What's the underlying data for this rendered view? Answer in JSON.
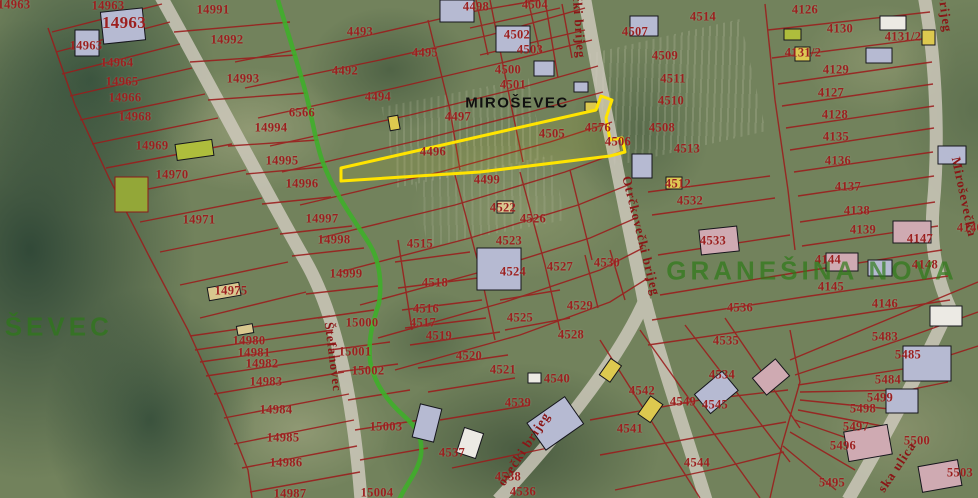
{
  "map": {
    "place_label": {
      "t": "MIROŠEVEC"
    },
    "district_labels": [
      {
        "t": "KUŠEVEC",
        "x": 36,
        "y": 327
      },
      {
        "t": "GRANEŠINA NOVA",
        "x": 812,
        "y": 271
      }
    ],
    "street_labels": [
      {
        "t": "Štefanovec",
        "x": 333,
        "y": 357,
        "r": 83
      },
      {
        "t": "čki brijeg",
        "x": 579,
        "y": 27,
        "r": 86
      },
      {
        "t": "Otrčkovečki brijeg",
        "x": 641,
        "y": 236,
        "r": 76
      },
      {
        "t": "ovečki brijeg",
        "x": 524,
        "y": 449,
        "r": -57
      },
      {
        "t": "Miroševečka",
        "x": 964,
        "y": 197,
        "r": 78
      },
      {
        "t": "brijeg",
        "x": 945,
        "y": 13,
        "r": 82
      },
      {
        "t": "ska ulica",
        "x": 897,
        "y": 467,
        "r": -56
      }
    ],
    "highlight_parcel": {
      "id": "4496",
      "outline": "#ffe400"
    },
    "parcel_labels": [
      {
        "t": "14963",
        "x": 14,
        "y": 5
      },
      {
        "t": "14963",
        "x": 108,
        "y": 6
      },
      {
        "t": "14963",
        "x": 124,
        "y": 23,
        "s": 17
      },
      {
        "t": "14963",
        "x": 86,
        "y": 46
      },
      {
        "t": "14964",
        "x": 117,
        "y": 63
      },
      {
        "t": "14965",
        "x": 122,
        "y": 82
      },
      {
        "t": "14966",
        "x": 125,
        "y": 98
      },
      {
        "t": "14968",
        "x": 135,
        "y": 117
      },
      {
        "t": "14969",
        "x": 152,
        "y": 146
      },
      {
        "t": "14970",
        "x": 172,
        "y": 175
      },
      {
        "t": "14971",
        "x": 199,
        "y": 220
      },
      {
        "t": "14975",
        "x": 231,
        "y": 291
      },
      {
        "t": "14980",
        "x": 249,
        "y": 341
      },
      {
        "t": "14981",
        "x": 254,
        "y": 353
      },
      {
        "t": "14982",
        "x": 262,
        "y": 364
      },
      {
        "t": "14983",
        "x": 266,
        "y": 382
      },
      {
        "t": "14984",
        "x": 276,
        "y": 410
      },
      {
        "t": "14985",
        "x": 283,
        "y": 438
      },
      {
        "t": "14986",
        "x": 286,
        "y": 463
      },
      {
        "t": "14987",
        "x": 290,
        "y": 494
      },
      {
        "t": "14991",
        "x": 213,
        "y": 10
      },
      {
        "t": "14992",
        "x": 227,
        "y": 40
      },
      {
        "t": "14993",
        "x": 243,
        "y": 79
      },
      {
        "t": "14994",
        "x": 271,
        "y": 128
      },
      {
        "t": "14995",
        "x": 282,
        "y": 161
      },
      {
        "t": "14996",
        "x": 302,
        "y": 184
      },
      {
        "t": "14997",
        "x": 322,
        "y": 219
      },
      {
        "t": "14998",
        "x": 334,
        "y": 240
      },
      {
        "t": "14999",
        "x": 346,
        "y": 274
      },
      {
        "t": "15000",
        "x": 362,
        "y": 323
      },
      {
        "t": "15001",
        "x": 355,
        "y": 352
      },
      {
        "t": "15002",
        "x": 368,
        "y": 371
      },
      {
        "t": "15003",
        "x": 386,
        "y": 427
      },
      {
        "t": "15004",
        "x": 377,
        "y": 493
      },
      {
        "t": "6566",
        "x": 302,
        "y": 113
      },
      {
        "t": "4492",
        "x": 345,
        "y": 71
      },
      {
        "t": "4493",
        "x": 360,
        "y": 32
      },
      {
        "t": "4494",
        "x": 378,
        "y": 97
      },
      {
        "t": "4495",
        "x": 425,
        "y": 53
      },
      {
        "t": "4496",
        "x": 433,
        "y": 152
      },
      {
        "t": "4497",
        "x": 458,
        "y": 117
      },
      {
        "t": "4498",
        "x": 476,
        "y": 7
      },
      {
        "t": "4499",
        "x": 487,
        "y": 180
      },
      {
        "t": "4500",
        "x": 508,
        "y": 70
      },
      {
        "t": "4501",
        "x": 513,
        "y": 85
      },
      {
        "t": "4502",
        "x": 517,
        "y": 35
      },
      {
        "t": "4503",
        "x": 530,
        "y": 50
      },
      {
        "t": "4504",
        "x": 535,
        "y": 5
      },
      {
        "t": "4505",
        "x": 552,
        "y": 134
      },
      {
        "t": "4506",
        "x": 618,
        "y": 142
      },
      {
        "t": "4507",
        "x": 635,
        "y": 32
      },
      {
        "t": "4508",
        "x": 662,
        "y": 128
      },
      {
        "t": "4509",
        "x": 665,
        "y": 56
      },
      {
        "t": "4510",
        "x": 671,
        "y": 101
      },
      {
        "t": "4511",
        "x": 673,
        "y": 79
      },
      {
        "t": "4512",
        "x": 678,
        "y": 184
      },
      {
        "t": "4513",
        "x": 687,
        "y": 149
      },
      {
        "t": "4514",
        "x": 703,
        "y": 17
      },
      {
        "t": "4515",
        "x": 420,
        "y": 244
      },
      {
        "t": "4516",
        "x": 426,
        "y": 309
      },
      {
        "t": "4517",
        "x": 423,
        "y": 323
      },
      {
        "t": "4518",
        "x": 435,
        "y": 283
      },
      {
        "t": "4519",
        "x": 439,
        "y": 336
      },
      {
        "t": "4520",
        "x": 469,
        "y": 356
      },
      {
        "t": "4521",
        "x": 503,
        "y": 370
      },
      {
        "t": "4522",
        "x": 503,
        "y": 208
      },
      {
        "t": "4523",
        "x": 509,
        "y": 241
      },
      {
        "t": "4524",
        "x": 513,
        "y": 272
      },
      {
        "t": "4525",
        "x": 520,
        "y": 318
      },
      {
        "t": "4526",
        "x": 533,
        "y": 219
      },
      {
        "t": "4527",
        "x": 560,
        "y": 267
      },
      {
        "t": "4528",
        "x": 571,
        "y": 335
      },
      {
        "t": "4529",
        "x": 580,
        "y": 306
      },
      {
        "t": "4530",
        "x": 607,
        "y": 263
      },
      {
        "t": "4532",
        "x": 690,
        "y": 201
      },
      {
        "t": "4533",
        "x": 713,
        "y": 241
      },
      {
        "t": "4534",
        "x": 722,
        "y": 375
      },
      {
        "t": "4535",
        "x": 726,
        "y": 341
      },
      {
        "t": "4536",
        "x": 740,
        "y": 308
      },
      {
        "t": "4536",
        "x": 523,
        "y": 492
      },
      {
        "t": "4537",
        "x": 452,
        "y": 453
      },
      {
        "t": "4538",
        "x": 508,
        "y": 477
      },
      {
        "t": "4539",
        "x": 518,
        "y": 403
      },
      {
        "t": "4540",
        "x": 557,
        "y": 379
      },
      {
        "t": "4541",
        "x": 630,
        "y": 429
      },
      {
        "t": "4542",
        "x": 642,
        "y": 391
      },
      {
        "t": "4544",
        "x": 697,
        "y": 463
      },
      {
        "t": "4545",
        "x": 715,
        "y": 405
      },
      {
        "t": "4549",
        "x": 683,
        "y": 402
      },
      {
        "t": "4576",
        "x": 598,
        "y": 128
      },
      {
        "t": "4126",
        "x": 805,
        "y": 10
      },
      {
        "t": "4127",
        "x": 831,
        "y": 93
      },
      {
        "t": "4128",
        "x": 835,
        "y": 115
      },
      {
        "t": "4129",
        "x": 836,
        "y": 70
      },
      {
        "t": "4130",
        "x": 840,
        "y": 29
      },
      {
        "t": "4131/2",
        "x": 803,
        "y": 53
      },
      {
        "t": "4131/2",
        "x": 903,
        "y": 37
      },
      {
        "t": "4135",
        "x": 836,
        "y": 137
      },
      {
        "t": "4136",
        "x": 838,
        "y": 161
      },
      {
        "t": "4137",
        "x": 848,
        "y": 187
      },
      {
        "t": "4138",
        "x": 857,
        "y": 211
      },
      {
        "t": "4139",
        "x": 863,
        "y": 230
      },
      {
        "t": "4140",
        "x": 970,
        "y": 228
      },
      {
        "t": "4144",
        "x": 828,
        "y": 260
      },
      {
        "t": "4145",
        "x": 831,
        "y": 287
      },
      {
        "t": "4146",
        "x": 885,
        "y": 304
      },
      {
        "t": "4147",
        "x": 920,
        "y": 239
      },
      {
        "t": "4148",
        "x": 925,
        "y": 265
      },
      {
        "t": "5483",
        "x": 885,
        "y": 337
      },
      {
        "t": "5484",
        "x": 888,
        "y": 380
      },
      {
        "t": "5485",
        "x": 908,
        "y": 355
      },
      {
        "t": "5495",
        "x": 832,
        "y": 483
      },
      {
        "t": "5496",
        "x": 843,
        "y": 446
      },
      {
        "t": "5497",
        "x": 856,
        "y": 427
      },
      {
        "t": "5498",
        "x": 863,
        "y": 409
      },
      {
        "t": "5499",
        "x": 880,
        "y": 398
      },
      {
        "t": "5500",
        "x": 917,
        "y": 441
      },
      {
        "t": "5503",
        "x": 960,
        "y": 473
      }
    ],
    "colors": {
      "parcel_line": "#9b1c1c",
      "parcel_text": "#9c1f1f",
      "street_text": "#8a1616",
      "district_text": "#2c7a16",
      "place_text": "#101010",
      "highlight": "#ffe400",
      "path_green": "#3fae2a",
      "road": "#d2ccc0"
    }
  }
}
